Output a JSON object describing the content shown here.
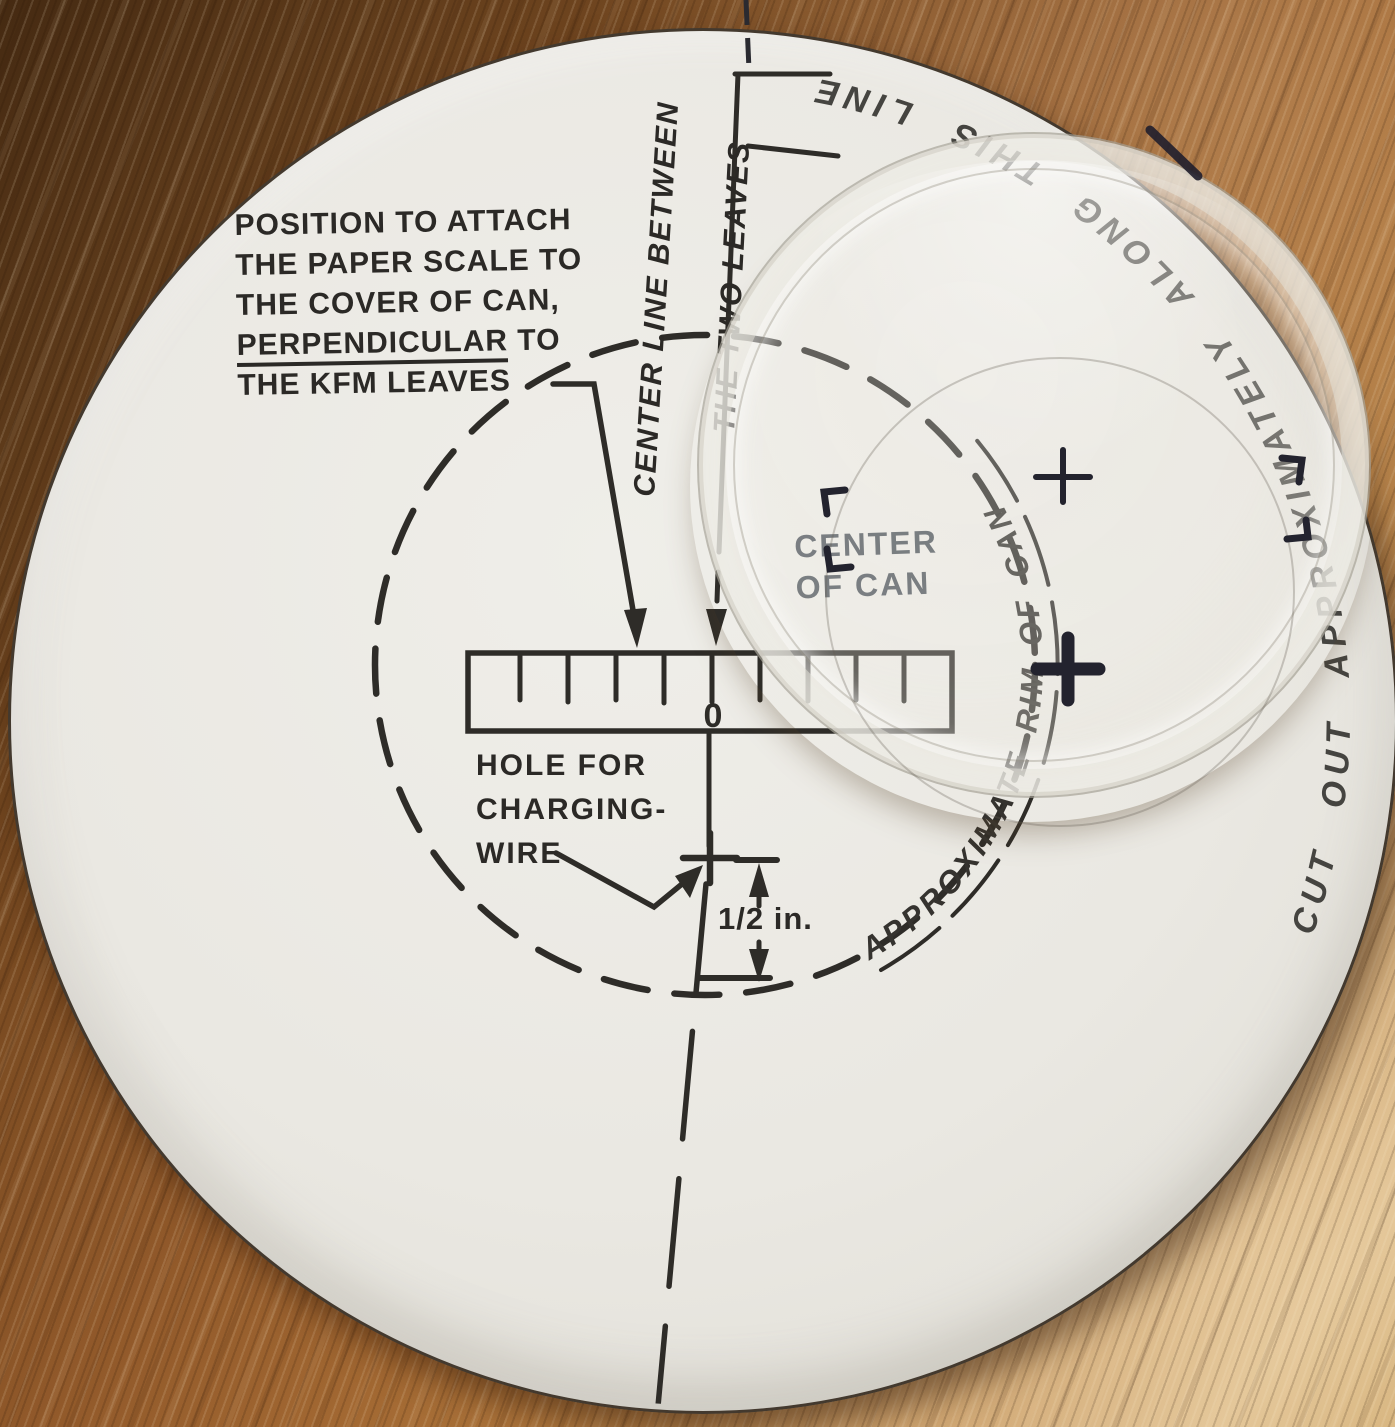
{
  "scene": {
    "description": "Photo of a KFM paper pattern on a wooden table, with a transparent plastic can lid lying over its upper-right part",
    "colors": {
      "wood_dark": "#452a12",
      "wood_light": "#d8b684",
      "paper": "#eae8e2",
      "ink": "#2e2c28",
      "under_lid_ink": "#4e545b",
      "pen": "#23232e"
    }
  },
  "paper": {
    "instruction_block": {
      "line1": "POSITION TO ATTACH",
      "line2": "THE PAPER SCALE TO",
      "line3": "THE COVER OF CAN,",
      "line4_underlined": "PERPENDICULAR",
      "line4_rest": " TO",
      "line5": "THE KFM LEAVES"
    },
    "center_line_label": {
      "line1": "CENTER LINE BETWEEN",
      "line2": "THE TWO LEAVES"
    },
    "center_of_can_label": {
      "line1": "CENTER",
      "line2": "OF CAN"
    },
    "hole_label": {
      "line1": "HOLE FOR",
      "line2": "CHARGING-",
      "line3": "WIRE"
    },
    "dimension_label": "1/2 in.",
    "scale_zero": "0",
    "rim_label": "APPROXIMATE RIM OF CAN",
    "edge_label": "CUT OUT APPROXIMATELY ALONG THIS LINE"
  }
}
